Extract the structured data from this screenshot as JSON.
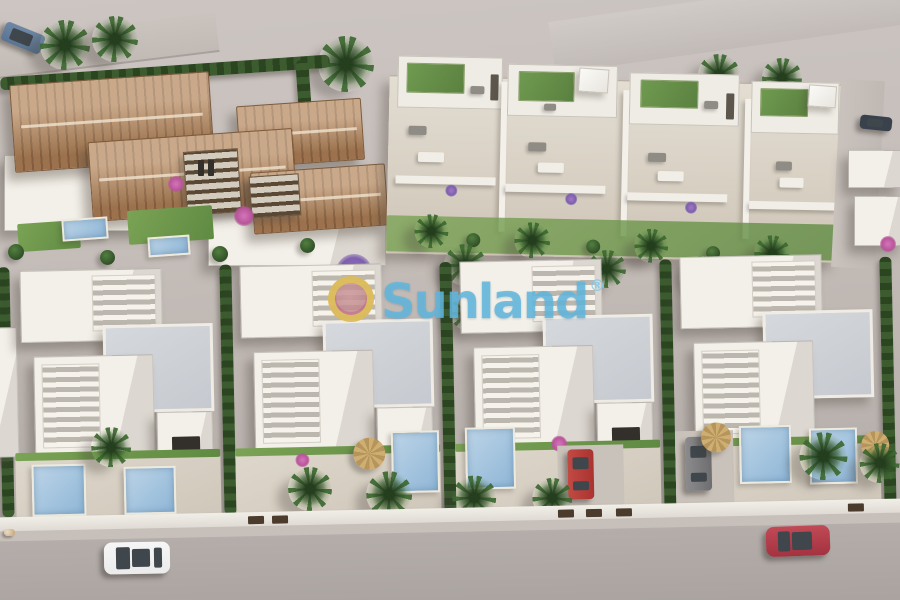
{
  "watermark": {
    "brand": "Sunland",
    "registered_mark": "®"
  },
  "colors": {
    "ground-far": "#ccc5c1",
    "ground": "#c0b8b3",
    "road": "#aea7a3",
    "sun-white": "#f3f0e9",
    "shade-white": "#dcd7d0",
    "roof-white": "#efece5",
    "roof-gray": "#c6cad0",
    "terracotta": "#b0835a",
    "terracotta-dark": "#916845",
    "hedge": "#3c5c30",
    "hedge-dark": "#2b4521",
    "lawn": "#6f9a50",
    "lawn-dark": "#5f8a42",
    "pool-1": "#bcd4e7",
    "pool-2": "#8fb6d6",
    "bloom-magenta": "#b8559a",
    "bloom-purple": "#7d5fae",
    "bloom-orange": "#c96a35",
    "umbrella": "#cfae72",
    "gate": "#4a3b2c",
    "glass": "#3f464c",
    "car-steel": "#5a7491",
    "car-dark": "#39414d",
    "car-red": "#aa3330",
    "car-darkred": "#a43240",
    "car-gray": "#6e6e70",
    "car-white": "#ebebeb",
    "watermark-blue": "#62b6dd",
    "logo-gold": "#e2c64e",
    "logo-rose": "#c59093"
  },
  "scene": {
    "description": "Aerial 3D architectural render of a residential development: Mediterranean villas with terracotta tiled roofs (top left), white townhouses with rooftop lawn terraces and pergolas (top right), two staggered rows of modern white flat-roof villas with slatted roof terraces, private pools, palm gardens and driveways (center/bottom), bounded by a white perimeter wall, sidewalk and a wide gray road in the foreground.",
    "areas": [
      {
        "name": "terracotta-villa-row",
        "label": "Terracotta-roof villas"
      },
      {
        "name": "townhouse-row",
        "label": "Townhouses with rooftop terraces"
      },
      {
        "name": "modern-villa-row",
        "label": "Modern white villas with pools"
      },
      {
        "name": "main-road",
        "label": "Foreground road"
      }
    ],
    "cars": [
      {
        "color": "steel-blue",
        "location": "top-left street"
      },
      {
        "color": "dark-gray",
        "location": "right-side street"
      },
      {
        "color": "red",
        "location": "villa driveway"
      },
      {
        "color": "gray",
        "location": "villa driveway"
      },
      {
        "color": "white",
        "location": "main road"
      },
      {
        "color": "dark-red",
        "location": "main road"
      }
    ],
    "pools_visible": 8,
    "animal": {
      "type": "dog",
      "location": "bottom-left sidewalk"
    }
  }
}
